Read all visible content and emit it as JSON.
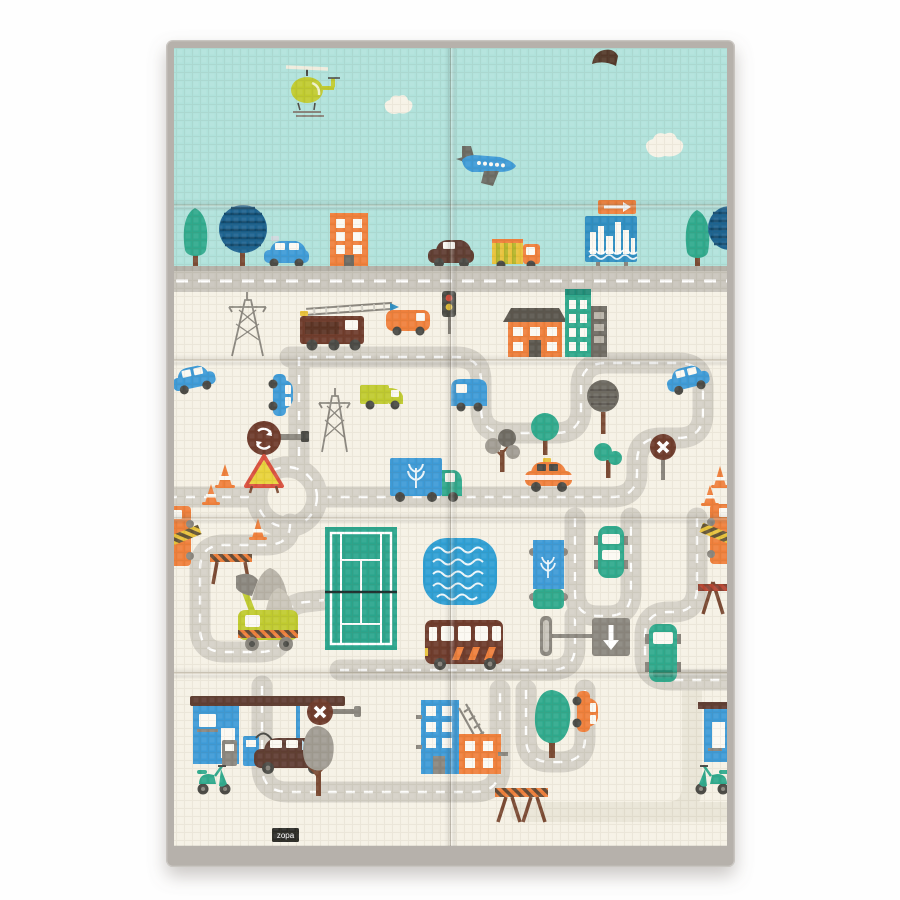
{
  "product": {
    "brand_label": "zopa",
    "item": "foldable baby play mat, city roads print",
    "mat": {
      "fold_rows": 5,
      "fold_cols": 2
    }
  },
  "colors": {
    "sky": "#b0e2db",
    "cream": "#f5f1e5",
    "road": "#d5d1c7",
    "roadFaded": "#e9e5d7",
    "rdBand": "#c9c5bc",
    "rdBandDark": "#b2aea5",
    "teal": "#2fa98c",
    "blue": "#3e9ad6",
    "blueDeep": "#1d6390",
    "boardBlue": "#2e8ec2",
    "poolBlue": "#2e9fd4",
    "court": "#2aa58c",
    "orange": "#ef7f3a",
    "maroon": "#6e3a2c",
    "carBrown": "#5f3c30",
    "lime": "#bfca2f",
    "yellow": "#e8c23a",
    "signYellow": "#e8d23a",
    "red": "#d9503e",
    "redDark": "#b5432f",
    "grayA": "#8a867e",
    "grayB": "#6e6a62",
    "grayC": "#b8b3a8",
    "grayTree": "#a19c93",
    "dark": "#4a4a44",
    "trunk": "#7a4a33",
    "cloud": "#f6f2e6",
    "border": "#b6b1ab",
    "borderDark": "#97928c",
    "labelBg": "#2b2b28"
  },
  "scene": {
    "sky": [
      "helicopter",
      "cloud",
      "cloud",
      "airplane",
      "bird"
    ],
    "city_strip": [
      "conical-tree",
      "striped-round-tree",
      "police-car",
      "orange-building",
      "brown-car",
      "cargo-truck",
      "billboard",
      "arrow-sign",
      "conical-tree",
      "striped-round-tree"
    ],
    "upper_town": [
      "power-pylon",
      "fire-truck",
      "orange-van",
      "traffic-light",
      "orange-house",
      "teal-building",
      "gray-building"
    ],
    "mid_town": [
      "blue-car",
      "blue-car",
      "power-pylon",
      "lime-truck",
      "blue-van",
      "roundabout-sign",
      "traffic-cones",
      "warning-triangle-sign",
      "delivery-truck",
      "taxi",
      "round-trees",
      "no-entry-sign",
      "blue-car",
      "traffic-cones"
    ],
    "park_row": [
      "crane-truck",
      "cone",
      "stripe-barrier",
      "rocks",
      "excavator",
      "tennis-court",
      "swimming-pool",
      "bus",
      "delivery-truck-top",
      "teal-car-top",
      "down-arrow-sign",
      "teal-van-top",
      "tripod-barrier",
      "crane-truck"
    ],
    "bottom_row": [
      "gas-station",
      "fuel-pumps",
      "scooter",
      "brown-wagon-car",
      "no-entry-sign",
      "gray-tree",
      "blue-apartment",
      "ladder",
      "orange-building",
      "teal-tree",
      "orange-car",
      "stripe-barrier",
      "blue-house",
      "scooter",
      "brand-label"
    ]
  }
}
